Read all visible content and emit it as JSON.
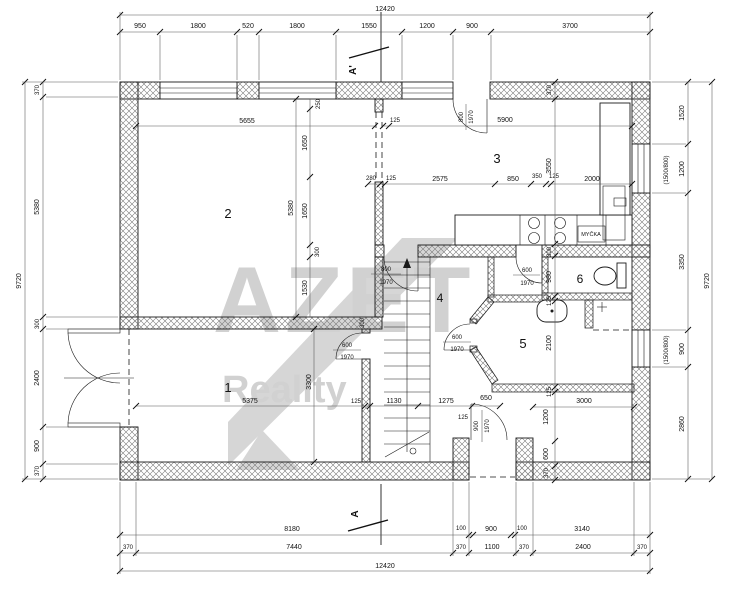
{
  "watermark": {
    "brand": "AZET",
    "sub": "Reality"
  },
  "section": {
    "top": "A'",
    "bottom": "A"
  },
  "rooms": {
    "r1": "1",
    "r2": "2",
    "r3": "3",
    "r4": "4",
    "r5": "5",
    "r6": "6"
  },
  "fixtures": {
    "dishwasher": "MYČKA"
  },
  "doors": {
    "kitchen": {
      "w": "800",
      "h": "1970"
    },
    "hall": {
      "w": "800",
      "h": "1970"
    },
    "garage": {
      "w": "600",
      "h": "1970"
    },
    "bath": {
      "w": "600",
      "h": "1970"
    },
    "wc": {
      "w": "600",
      "h": "1970"
    },
    "entrance": {
      "w": "900",
      "h": "1970"
    }
  },
  "dims": {
    "top": {
      "total": "12420",
      "s": [
        "950",
        "1800",
        "520",
        "1800",
        "1550",
        "1200",
        "900",
        "3700"
      ]
    },
    "bottom": {
      "r1": [
        "8180",
        "100",
        "900",
        "100",
        "3140"
      ],
      "r2": [
        "370",
        "7440",
        "370",
        "1100",
        "370",
        "2400",
        "370"
      ],
      "total": "12420"
    },
    "left": {
      "total": "9720",
      "s": [
        "370",
        "5380",
        "300",
        "2400",
        "900",
        "370"
      ]
    },
    "right": {
      "total": "9720",
      "s": [
        "1520",
        "1200",
        "3350",
        "900",
        "2860"
      ],
      "win1": "(1500/800)",
      "win2": "(1500/800)"
    },
    "room2": {
      "width": "5655",
      "height": "5380",
      "wall": "300",
      "chain": [
        "250",
        "1650",
        "1650",
        "300",
        "1530"
      ]
    },
    "room3": {
      "left": "125",
      "width": "5900",
      "chain": [
        "280",
        "125",
        "2575",
        "850",
        "350",
        "125",
        "2000"
      ]
    },
    "room1": {
      "width": "5375",
      "height": "3300",
      "wall": "125"
    },
    "hall": {
      "chain": [
        "1130",
        "1275",
        "650"
      ],
      "entry": "125"
    },
    "rightcol": {
      "chain": [
        "370",
        "3550",
        "300",
        "980",
        "125",
        "2100",
        "125",
        "1200",
        "600",
        "370"
      ],
      "porch": "3000"
    }
  }
}
